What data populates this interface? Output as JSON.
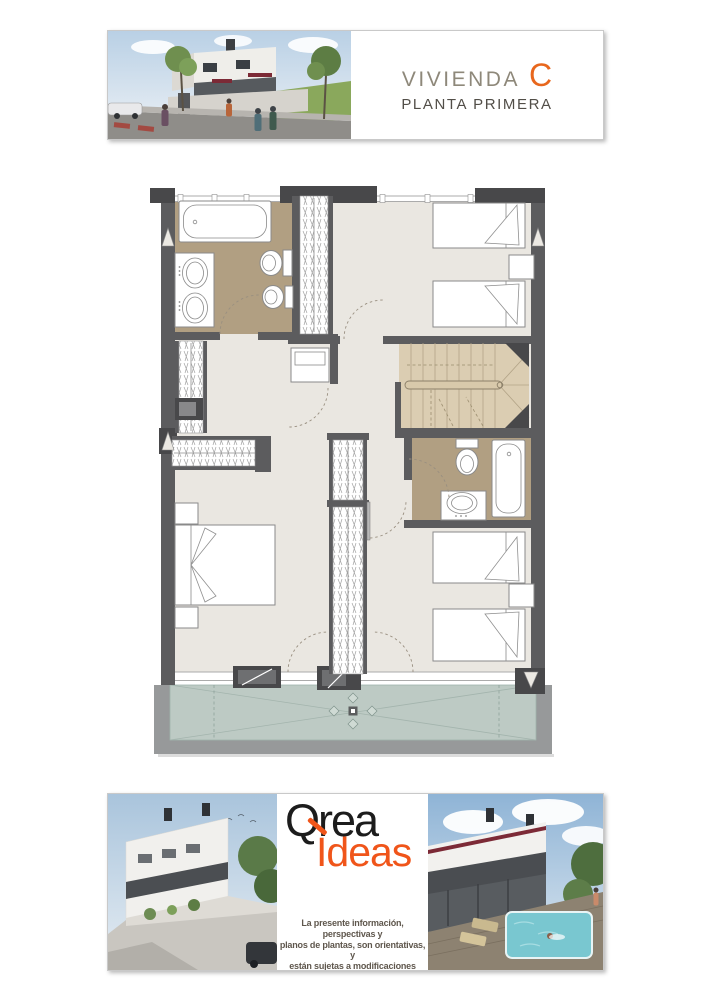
{
  "header": {
    "title": "VIVIENDA",
    "unit_letter": "C",
    "subtitle": "PLANTA PRIMERA"
  },
  "footer": {
    "brand_line1": "Qrea",
    "brand_line2": "Ideas",
    "disclaimer_lines": [
      "La presente información, perspectivas y",
      "planos de plantas, son orientativas, y",
      "están sujetas a modificaciones derivadas",
      "del proyecto técnico y de su ejecución"
    ]
  },
  "plan": {
    "type": "residential-floor-plan",
    "symbols": [
      "bathtub",
      "double-sink-vanity",
      "toilet",
      "bidet",
      "wardrobe",
      "single-bed",
      "double-bed",
      "nightstand",
      "staircase",
      "terrace",
      "door-swing"
    ]
  },
  "colors": {
    "accent_orange": "#e8671d",
    "logo_orange": "#f0551a",
    "logo_black": "#1c1c1c",
    "title_taupe": "#8e887a",
    "subtitle_gray": "#524e48",
    "disclaimer_brown": "#5f574d",
    "wall_dark": "#5c5c5e",
    "pier_dark": "#48484a",
    "floor_cream": "#eae7e1",
    "bathroom_tan": "#b19f82",
    "stair_tan": "#dbcdb2",
    "terrace_green": "#bdcac4",
    "pool_teal": "#79c7d0"
  }
}
